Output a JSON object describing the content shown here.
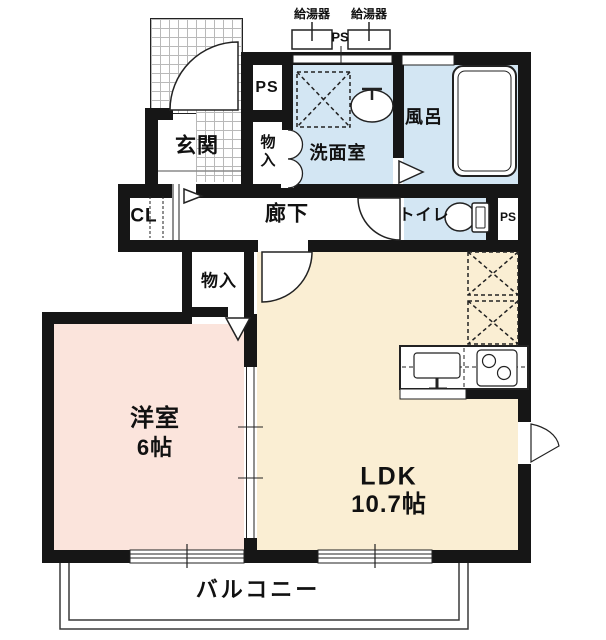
{
  "floorplan": {
    "equipment": {
      "water_heater_left": "給湯器",
      "water_heater_right": "給湯器",
      "ps_top": "PS",
      "ps_upper": "PS",
      "ps_lower": "PS"
    },
    "rooms": {
      "genkan": "玄関",
      "storage_top": "物入",
      "washroom": "洗面室",
      "bath": "風呂",
      "cl": "CL",
      "hallway": "廊下",
      "toilet": "トイレ",
      "storage_mid": "物入",
      "western": "洋室",
      "western_size": "6帖",
      "ldk": "LDK",
      "ldk_size": "10.7帖",
      "balcony": "バルコニー"
    },
    "colors": {
      "wall": "#161616",
      "wet_area_fill": "#d3e6f3",
      "western_room_fill": "#fbe4dc",
      "ldk_fill": "#faeed3",
      "background": "#ffffff"
    }
  }
}
